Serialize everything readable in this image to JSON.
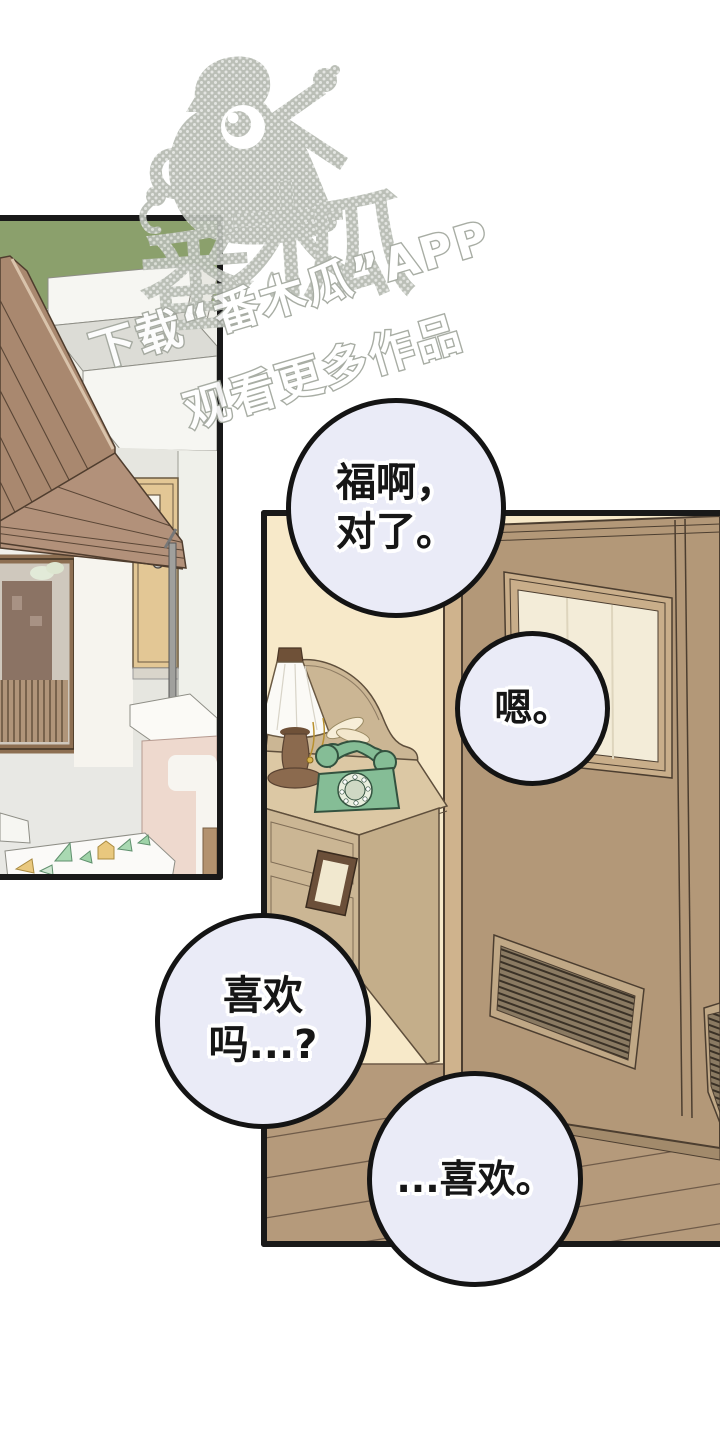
{
  "watermark": {
    "brand_chars": [
      "番",
      "木",
      "瓜"
    ],
    "download_line": "下载“番木瓜”APP",
    "watch_line": "观看更多作品",
    "mascot_icon": "papaya-mascot-icon"
  },
  "speech_bubbles": [
    {
      "id": "bubble-1",
      "lines": [
        "福啊，",
        "对了。"
      ]
    },
    {
      "id": "bubble-2",
      "lines": [
        "嗯。"
      ]
    },
    {
      "id": "bubble-3",
      "lines": [
        "喜欢",
        "吗...?"
      ]
    },
    {
      "id": "bubble-4",
      "lines": [
        "...喜欢。"
      ]
    }
  ],
  "icons": {
    "lamp": "table-lamp-icon",
    "phone": "rotary-phone-icon",
    "door": "wooden-door",
    "house": "house-exterior"
  },
  "colors": {
    "bubble_fill": "#eaebf7",
    "ink": "#161616",
    "wall_cream": "#f7e9c9",
    "door_brown": "#b39878",
    "door_frame_tan": "#c9ae8a",
    "floor_brown": "#b59a7b",
    "roof_brown": "#a9886f",
    "grass_green": "#8ba06c",
    "kiosk_pink": "#eed9ce",
    "phone_green": "#85bd96",
    "table_tan": "#cbb694",
    "watermark_gray": "#b6bbb2",
    "panel_border": "#191919"
  }
}
